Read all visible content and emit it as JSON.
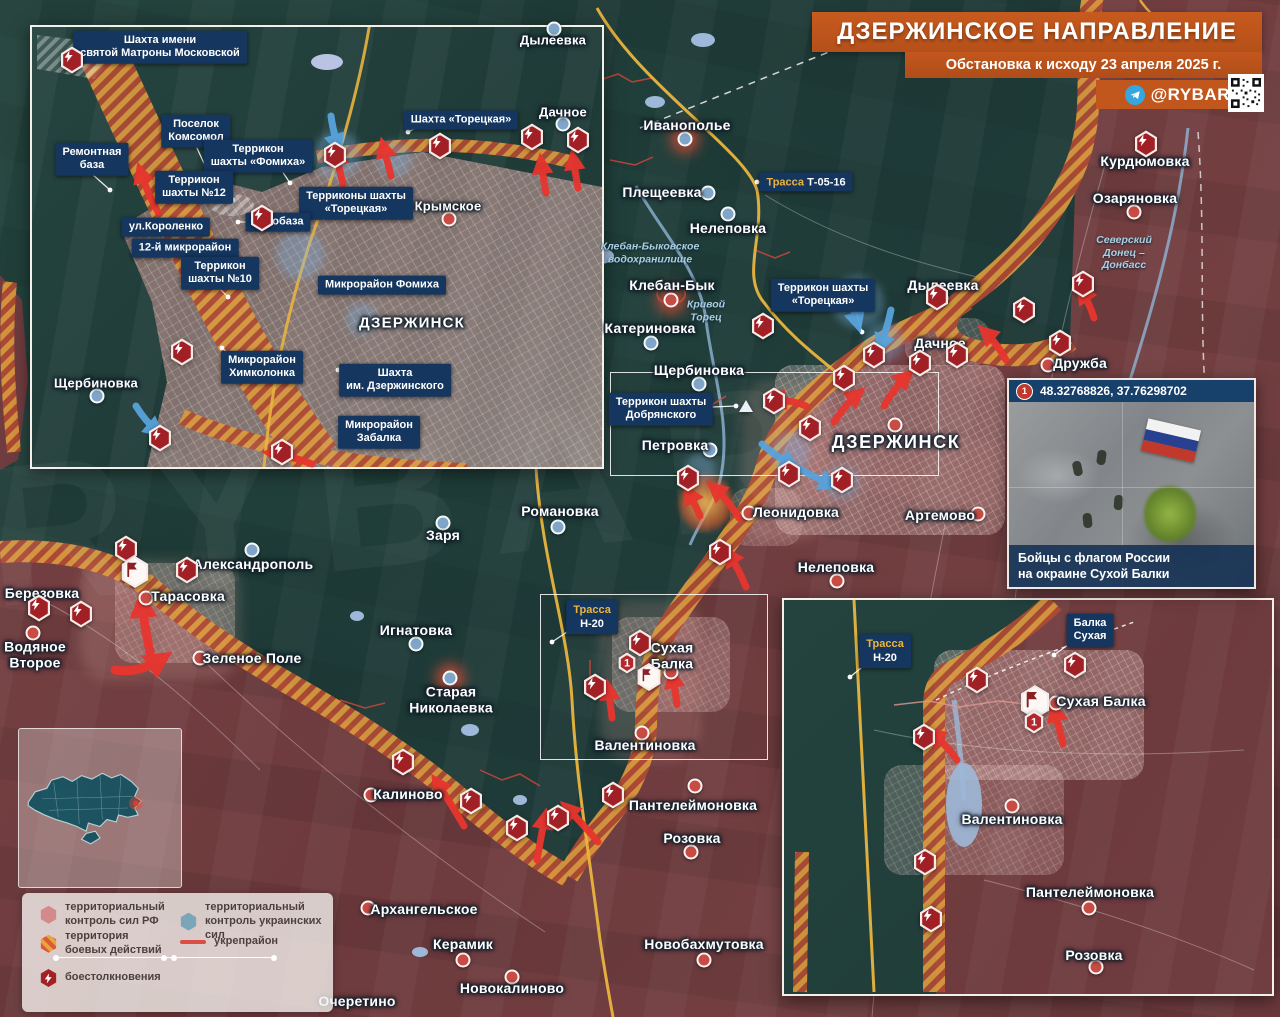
{
  "header": {
    "title": "ДЗЕРЖИНСКОЕ НАПРАВЛЕНИЕ",
    "subtitle": "Обстановка к исходу 23 апреля 2025 г.",
    "channel": "@RYBAR"
  },
  "colors": {
    "ua_territory": "#22413c",
    "ru_territory": "#6f3c3f",
    "battle_orange": "#db9a3e",
    "battle_red": "#b04a33",
    "label_box": "#14365f",
    "road_yellow": "#e9b43e",
    "arrow_red": "#e8352e",
    "arrow_blue": "#57a3dc",
    "marker_red": "#a02025",
    "banner_orange": "#c2571d"
  },
  "legend": {
    "items": [
      {
        "label": "территориальный\nконтроль сил РФ"
      },
      {
        "label": "территориальный\nконтроль украинских сил"
      },
      {
        "label": "территория\nбоевых действий"
      },
      {
        "label": "укрепрайон"
      },
      {
        "label": "боестолкновения"
      }
    ]
  },
  "photo_pan": {
    "marker": "1",
    "coords": "48.32768826, 37.76298702",
    "caption": "Бойцы с флагом России\nна окраине Сухой Балки"
  },
  "map_labels": {
    "cities": [
      {
        "text": "ДЗЕРЖИНСК",
        "x": 896,
        "y": 442,
        "cls": "big",
        "dot": {
          "x": 895,
          "y": 425,
          "side": "ru"
        }
      },
      {
        "text": "ДЗЕРЖИНСК",
        "x": 412,
        "y": 324,
        "cls": "mid"
      }
    ],
    "settlements": [
      {
        "text": "Иванополье",
        "x": 687,
        "y": 126,
        "dot": {
          "x": 685,
          "y": 139,
          "side": "ua",
          "glow": true
        }
      },
      {
        "text": "Плещеевка",
        "x": 662,
        "y": 193,
        "dot": {
          "x": 708,
          "y": 193,
          "side": "ua"
        }
      },
      {
        "text": "Нелеповка",
        "x": 728,
        "y": 229,
        "dot": {
          "x": 728,
          "y": 214,
          "side": "ua"
        }
      },
      {
        "text": "Клебан-Бык",
        "x": 672,
        "y": 286,
        "dot": {
          "x": 671,
          "y": 300,
          "side": "ru",
          "glow": true
        }
      },
      {
        "text": "Катериновка",
        "x": 650,
        "y": 329,
        "dot": {
          "x": 651,
          "y": 343,
          "side": "ua"
        }
      },
      {
        "text": "Щербиновка",
        "x": 699,
        "y": 371,
        "dot": {
          "x": 699,
          "y": 384,
          "side": "ua"
        }
      },
      {
        "text": "Петровка",
        "x": 675,
        "y": 446,
        "dot": {
          "x": 710,
          "y": 450,
          "side": "ua"
        }
      },
      {
        "text": "Дылеевка",
        "x": 943,
        "y": 286,
        "dot": {
          "x": 941,
          "y": 298,
          "side": "ua"
        }
      },
      {
        "text": "Дачное",
        "x": 940,
        "y": 344,
        "dot": {
          "x": 958,
          "y": 356,
          "side": "ru"
        }
      },
      {
        "text": "Дружба",
        "x": 1080,
        "y": 364,
        "dot": {
          "x": 1048,
          "y": 365,
          "side": "ru"
        }
      },
      {
        "text": "Курдюмовка",
        "x": 1145,
        "y": 162
      },
      {
        "text": "Озаряновка",
        "x": 1135,
        "y": 199,
        "dot": {
          "x": 1134,
          "y": 212,
          "side": "ru"
        }
      },
      {
        "text": "Артемово",
        "x": 940,
        "y": 516,
        "dot": {
          "x": 978,
          "y": 514,
          "side": "ru"
        }
      },
      {
        "text": "Леонидовка",
        "x": 796,
        "y": 513,
        "dot": {
          "x": 749,
          "y": 513,
          "side": "ru"
        }
      },
      {
        "text": "Нелеповка",
        "x": 836,
        "y": 568,
        "dot": {
          "x": 837,
          "y": 581,
          "side": "ru"
        }
      },
      {
        "text": "Романовка",
        "x": 560,
        "y": 512,
        "dot": {
          "x": 558,
          "y": 527,
          "side": "ua"
        }
      },
      {
        "text": "Заря",
        "x": 443,
        "y": 536,
        "dot": {
          "x": 443,
          "y": 523,
          "side": "ua"
        }
      },
      {
        "text": "Александрополь",
        "x": 253,
        "y": 565,
        "dot": {
          "x": 252,
          "y": 550,
          "side": "ua"
        }
      },
      {
        "text": "Тарасовка",
        "x": 188,
        "y": 597,
        "dot": {
          "x": 146,
          "y": 598,
          "side": "ru"
        }
      },
      {
        "text": "Березовка",
        "x": 42,
        "y": 594
      },
      {
        "text": "Водяное\nВторое",
        "x": 35,
        "y": 655,
        "dot": {
          "x": 33,
          "y": 633,
          "side": "ru"
        }
      },
      {
        "text": "Зеленое Поле",
        "x": 252,
        "y": 659,
        "dot": {
          "x": 200,
          "y": 658,
          "side": "ru"
        }
      },
      {
        "text": "Игнатовка",
        "x": 416,
        "y": 631,
        "dot": {
          "x": 416,
          "y": 644,
          "side": "ua"
        }
      },
      {
        "text": "Старая\nНиколаевка",
        "x": 451,
        "y": 700,
        "dot": {
          "x": 450,
          "y": 678,
          "side": "ua",
          "glow": true
        }
      },
      {
        "text": "Сухая\nБалка",
        "x": 672,
        "y": 656,
        "dot": {
          "x": 671,
          "y": 672,
          "side": "ru"
        }
      },
      {
        "text": "Валентиновка",
        "x": 645,
        "y": 746,
        "dot": {
          "x": 642,
          "y": 733,
          "side": "ru"
        }
      },
      {
        "text": "Пантелеймоновка",
        "x": 693,
        "y": 806,
        "dot": {
          "x": 695,
          "y": 786,
          "side": "ru"
        }
      },
      {
        "text": "Розовка",
        "x": 692,
        "y": 839,
        "dot": {
          "x": 691,
          "y": 852,
          "side": "ru"
        }
      },
      {
        "text": "Калиново",
        "x": 408,
        "y": 795,
        "dot": {
          "x": 371,
          "y": 795,
          "side": "ru"
        }
      },
      {
        "text": "Архангельское",
        "x": 424,
        "y": 910,
        "dot": {
          "x": 368,
          "y": 908,
          "side": "ru"
        }
      },
      {
        "text": "Керамик",
        "x": 463,
        "y": 945,
        "dot": {
          "x": 463,
          "y": 960,
          "side": "ru"
        }
      },
      {
        "text": "Новокалиново",
        "x": 512,
        "y": 989,
        "dot": {
          "x": 512,
          "y": 977,
          "side": "ru"
        }
      },
      {
        "text": "Очеретино",
        "x": 357,
        "y": 1002
      },
      {
        "text": "Новобахмутовка",
        "x": 704,
        "y": 945,
        "dot": {
          "x": 704,
          "y": 960,
          "side": "ru"
        }
      },
      {
        "text": "Дылеевка",
        "x": 553,
        "y": 41,
        "cls": "sm",
        "dot": {
          "x": 554,
          "y": 29,
          "side": "ua"
        }
      },
      {
        "text": "Дачное",
        "x": 563,
        "y": 113,
        "cls": "sm",
        "dot": {
          "x": 563,
          "y": 124,
          "side": "ua"
        }
      },
      {
        "text": "Крымское",
        "x": 448,
        "y": 207,
        "cls": "sm",
        "dot": {
          "x": 449,
          "y": 219,
          "side": "ru"
        }
      },
      {
        "text": "Щербиновка",
        "x": 96,
        "y": 384,
        "cls": "sm",
        "dot": {
          "x": 97,
          "y": 396,
          "side": "ua"
        }
      },
      {
        "text": "Сухая Балка",
        "x": 1101,
        "y": 702,
        "dot": {
          "x": 1056,
          "y": 703,
          "side": "ru"
        }
      },
      {
        "text": "Валентиновка",
        "x": 1012,
        "y": 820,
        "dot": {
          "x": 1012,
          "y": 806,
          "side": "ru"
        }
      },
      {
        "text": "Пантелеймоновка",
        "x": 1090,
        "y": 893,
        "dot": {
          "x": 1089,
          "y": 908,
          "side": "ru"
        }
      },
      {
        "text": "Розовка",
        "x": 1094,
        "y": 956,
        "dot": {
          "x": 1096,
          "y": 967,
          "side": "ru"
        }
      }
    ],
    "boxes": [
      {
        "text": "Шахта имени\nсвятой Матроны Московской",
        "x": 160,
        "y": 47,
        "lead": [
          100,
          57,
          78,
          64
        ]
      },
      {
        "text": "Поселок\nКомсомол",
        "x": 196,
        "y": 131,
        "lead": [
          196,
          146,
          208,
          172
        ]
      },
      {
        "text": "Шахта «Торецкая»",
        "x": 461,
        "y": 120,
        "lead": [
          420,
          126,
          408,
          132
        ]
      },
      {
        "text": "Ремонтная\nбаза",
        "x": 92,
        "y": 159,
        "lead": [
          92,
          174,
          110,
          190
        ]
      },
      {
        "text": "Террикон\nшахты «Фомиха»",
        "x": 258,
        "y": 156,
        "lead": [
          282,
          171,
          290,
          183
        ]
      },
      {
        "text": "Террикон\nшахты №12",
        "x": 194,
        "y": 187,
        "lead": [
          220,
          197,
          233,
          200
        ]
      },
      {
        "text": "Терриконы шахты\n«Торецкая»",
        "x": 356,
        "y": 203
      },
      {
        "text": "ул.Короленко",
        "x": 166,
        "y": 227
      },
      {
        "text": "Автобаза",
        "x": 278,
        "y": 222,
        "lead": [
          249,
          222,
          238,
          222
        ]
      },
      {
        "text": "12-й микрорайон",
        "x": 185,
        "y": 248
      },
      {
        "text": "Террикон\nшахты №10",
        "x": 220,
        "y": 273,
        "lead": [
          220,
          289,
          228,
          297
        ]
      },
      {
        "text": "Микрорайон Фомиха",
        "x": 382,
        "y": 285,
        "lead": [
          337,
          285,
          322,
          285
        ]
      },
      {
        "text": "Микрорайон\nХимколонка",
        "x": 262,
        "y": 367,
        "lead": [
          234,
          358,
          222,
          348
        ]
      },
      {
        "text": "Шахта\nим. Дзержинского",
        "x": 395,
        "y": 380,
        "lead": [
          350,
          374,
          338,
          370
        ]
      },
      {
        "text": "Микрорайон\nЗабалка",
        "x": 379,
        "y": 432,
        "lead": [
          352,
          428,
          340,
          424
        ]
      },
      {
        "text": "Террикон шахты\n«Торецкая»",
        "x": 823,
        "y": 295,
        "lead": [
          855,
          308,
          862,
          332
        ]
      },
      {
        "text": "Террикон шахты\nДобрянского",
        "x": 661,
        "y": 409,
        "lead": [
          712,
          407,
          736,
          406
        ]
      },
      {
        "text": "Балка\nСухая",
        "x": 1090,
        "y": 630,
        "lead": [
          1072,
          642,
          1054,
          655
        ]
      }
    ],
    "roads": [
      {
        "prefix": "Трасса",
        "value": "Т-05-16",
        "x": 806,
        "y": 182,
        "stack": false,
        "lead": [
          768,
          182,
          757,
          182
        ]
      },
      {
        "prefix": "Трасса",
        "value": "Н-20",
        "x": 592,
        "y": 617,
        "stack": true,
        "lead": [
          570,
          630,
          552,
          642
        ]
      },
      {
        "prefix": "Трасса",
        "value": "Н-20",
        "x": 885,
        "y": 651,
        "stack": true,
        "lead": [
          866,
          664,
          850,
          677
        ]
      }
    ],
    "water": [
      {
        "text": "Клебан-Быковское\nводохранилище",
        "x": 650,
        "y": 253
      },
      {
        "text": "Кривой\nТорец",
        "x": 706,
        "y": 311
      },
      {
        "text": "Северский\nДонец –\nДонбасс",
        "x": 1124,
        "y": 253
      }
    ]
  },
  "markers": {
    "bolts": [
      [
        72,
        60
      ],
      [
        335,
        155
      ],
      [
        440,
        146
      ],
      [
        262,
        218
      ],
      [
        182,
        352
      ],
      [
        160,
        438
      ],
      [
        282,
        452
      ],
      [
        532,
        137
      ],
      [
        578,
        140
      ],
      [
        1146,
        144
      ],
      [
        1083,
        284
      ],
      [
        1024,
        310
      ],
      [
        1060,
        343
      ],
      [
        937,
        297
      ],
      [
        874,
        355
      ],
      [
        920,
        363
      ],
      [
        957,
        355
      ],
      [
        844,
        378
      ],
      [
        774,
        401
      ],
      [
        810,
        428
      ],
      [
        789,
        474
      ],
      [
        842,
        480
      ],
      [
        763,
        326
      ],
      [
        688,
        478
      ],
      [
        720,
        552
      ],
      [
        126,
        549
      ],
      [
        187,
        570
      ],
      [
        39,
        608
      ],
      [
        81,
        614
      ],
      [
        471,
        801
      ],
      [
        517,
        828
      ],
      [
        558,
        818
      ],
      [
        613,
        795
      ],
      [
        595,
        687
      ],
      [
        640,
        643
      ],
      [
        403,
        762
      ],
      [
        977,
        680
      ],
      [
        1075,
        665
      ],
      [
        924,
        737
      ],
      [
        925,
        862
      ],
      [
        931,
        919
      ]
    ],
    "flags": [
      {
        "x": 135,
        "y": 572,
        "s": 30
      },
      {
        "x": 649,
        "y": 677,
        "s": 26
      },
      {
        "x": 1035,
        "y": 702,
        "s": 32
      }
    ],
    "ones": [
      {
        "x": 627,
        "y": 663,
        "s": 19,
        "label": "1"
      },
      {
        "x": 1034,
        "y": 722,
        "s": 21,
        "label": "1"
      }
    ],
    "triangles": [
      {
        "x": 746,
        "y": 406
      }
    ]
  },
  "arrows": {
    "red": [
      {
        "d": "M158,212 Q146,190 140,170"
      },
      {
        "d": "M343,184 Q339,168 336,152"
      },
      {
        "d": "M391,176 Q387,160 383,145"
      },
      {
        "d": "M546,193 Q543,177 541,161"
      },
      {
        "d": "M578,188 Q575,172 573,157"
      },
      {
        "d": "M312,464 Q292,456 270,453"
      },
      {
        "d": "M1006,360 Q996,342 984,331"
      },
      {
        "d": "M1094,318 Q1089,302 1081,290"
      },
      {
        "d": "M884,406 Q895,387 908,375"
      },
      {
        "d": "M834,422 Q846,404 859,393"
      },
      {
        "d": "M806,406 Q789,399 773,401"
      },
      {
        "d": "M739,518 Q728,500 713,487"
      },
      {
        "d": "M746,587 Q739,569 728,553"
      },
      {
        "d": "M150,652 Q144,624 142,601",
        "w": 9
      },
      {
        "d": "M115,670 Q139,674 163,658",
        "w": 9
      },
      {
        "d": "M612,718 Q610,701 608,687"
      },
      {
        "d": "M677,704 Q675,689 672,675"
      },
      {
        "d": "M464,826 Q450,802 436,781"
      },
      {
        "d": "M537,860 Q541,837 545,816"
      },
      {
        "d": "M598,842 Q581,822 566,807"
      },
      {
        "d": "M957,760 Q946,744 931,733"
      },
      {
        "d": "M1063,744 Q1059,726 1054,709"
      },
      {
        "d": "M700,516 Q694,502 688,491"
      }
    ],
    "blue": [
      {
        "d": "M331,116 Q333,131 338,147"
      },
      {
        "d": "M136,406 Q145,421 158,432"
      },
      {
        "d": "M849,290 Q853,308 858,325"
      },
      {
        "d": "M891,310 Q887,329 880,347"
      },
      {
        "d": "M762,444 Q777,457 793,466"
      },
      {
        "d": "M800,469 Q816,478 832,485"
      }
    ]
  }
}
